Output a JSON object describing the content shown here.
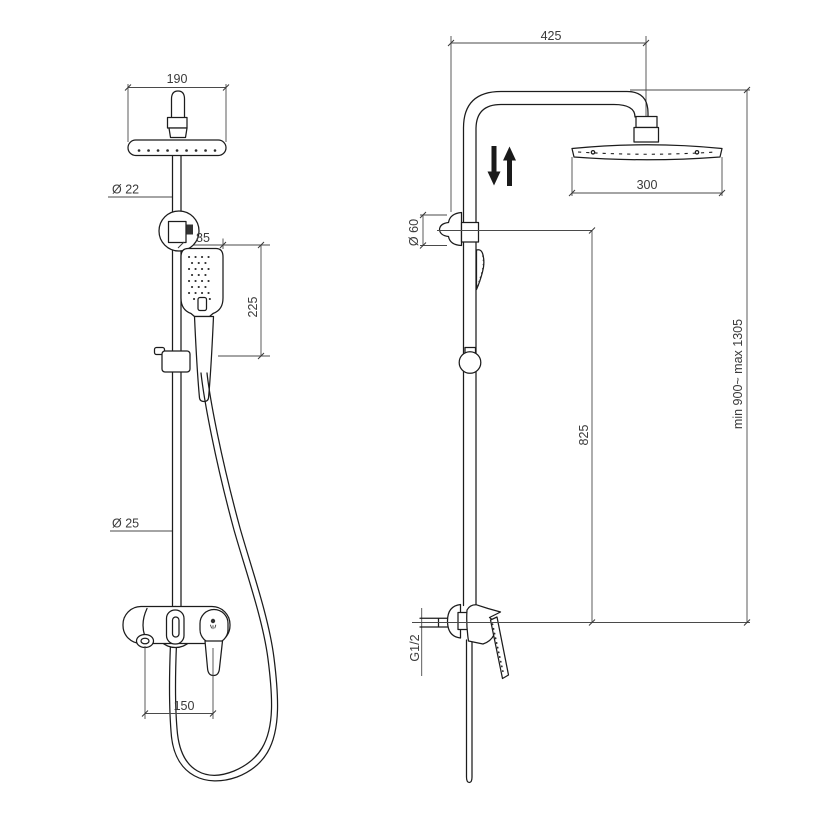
{
  "drawing": {
    "kind": "technical dimension drawing",
    "subject": "shower column with overhead shower, hand shower and mixer",
    "views": {
      "left": "front view",
      "right": "side view"
    }
  },
  "front_view": {
    "dim_head_width": "190",
    "dim_pipe_diameter": "Ø 22",
    "dim_handshower_width": "85",
    "dim_handshower_length": "225",
    "dim_rail_diameter": "Ø 25",
    "dim_inlet_spacing": "150"
  },
  "side_view": {
    "dim_arm_reach": "425",
    "dim_head_diameter": "300",
    "dim_bracket_diameter": "Ø 60",
    "dim_bracket_height": "825",
    "dim_total_height": "min 900~ max 1305",
    "dim_thread": "G1/2"
  },
  "colors": {
    "background": "#ffffff",
    "outline": "#1c1c1c",
    "dimension_line": "#4a4a4a",
    "text": "#3a3a3a"
  }
}
